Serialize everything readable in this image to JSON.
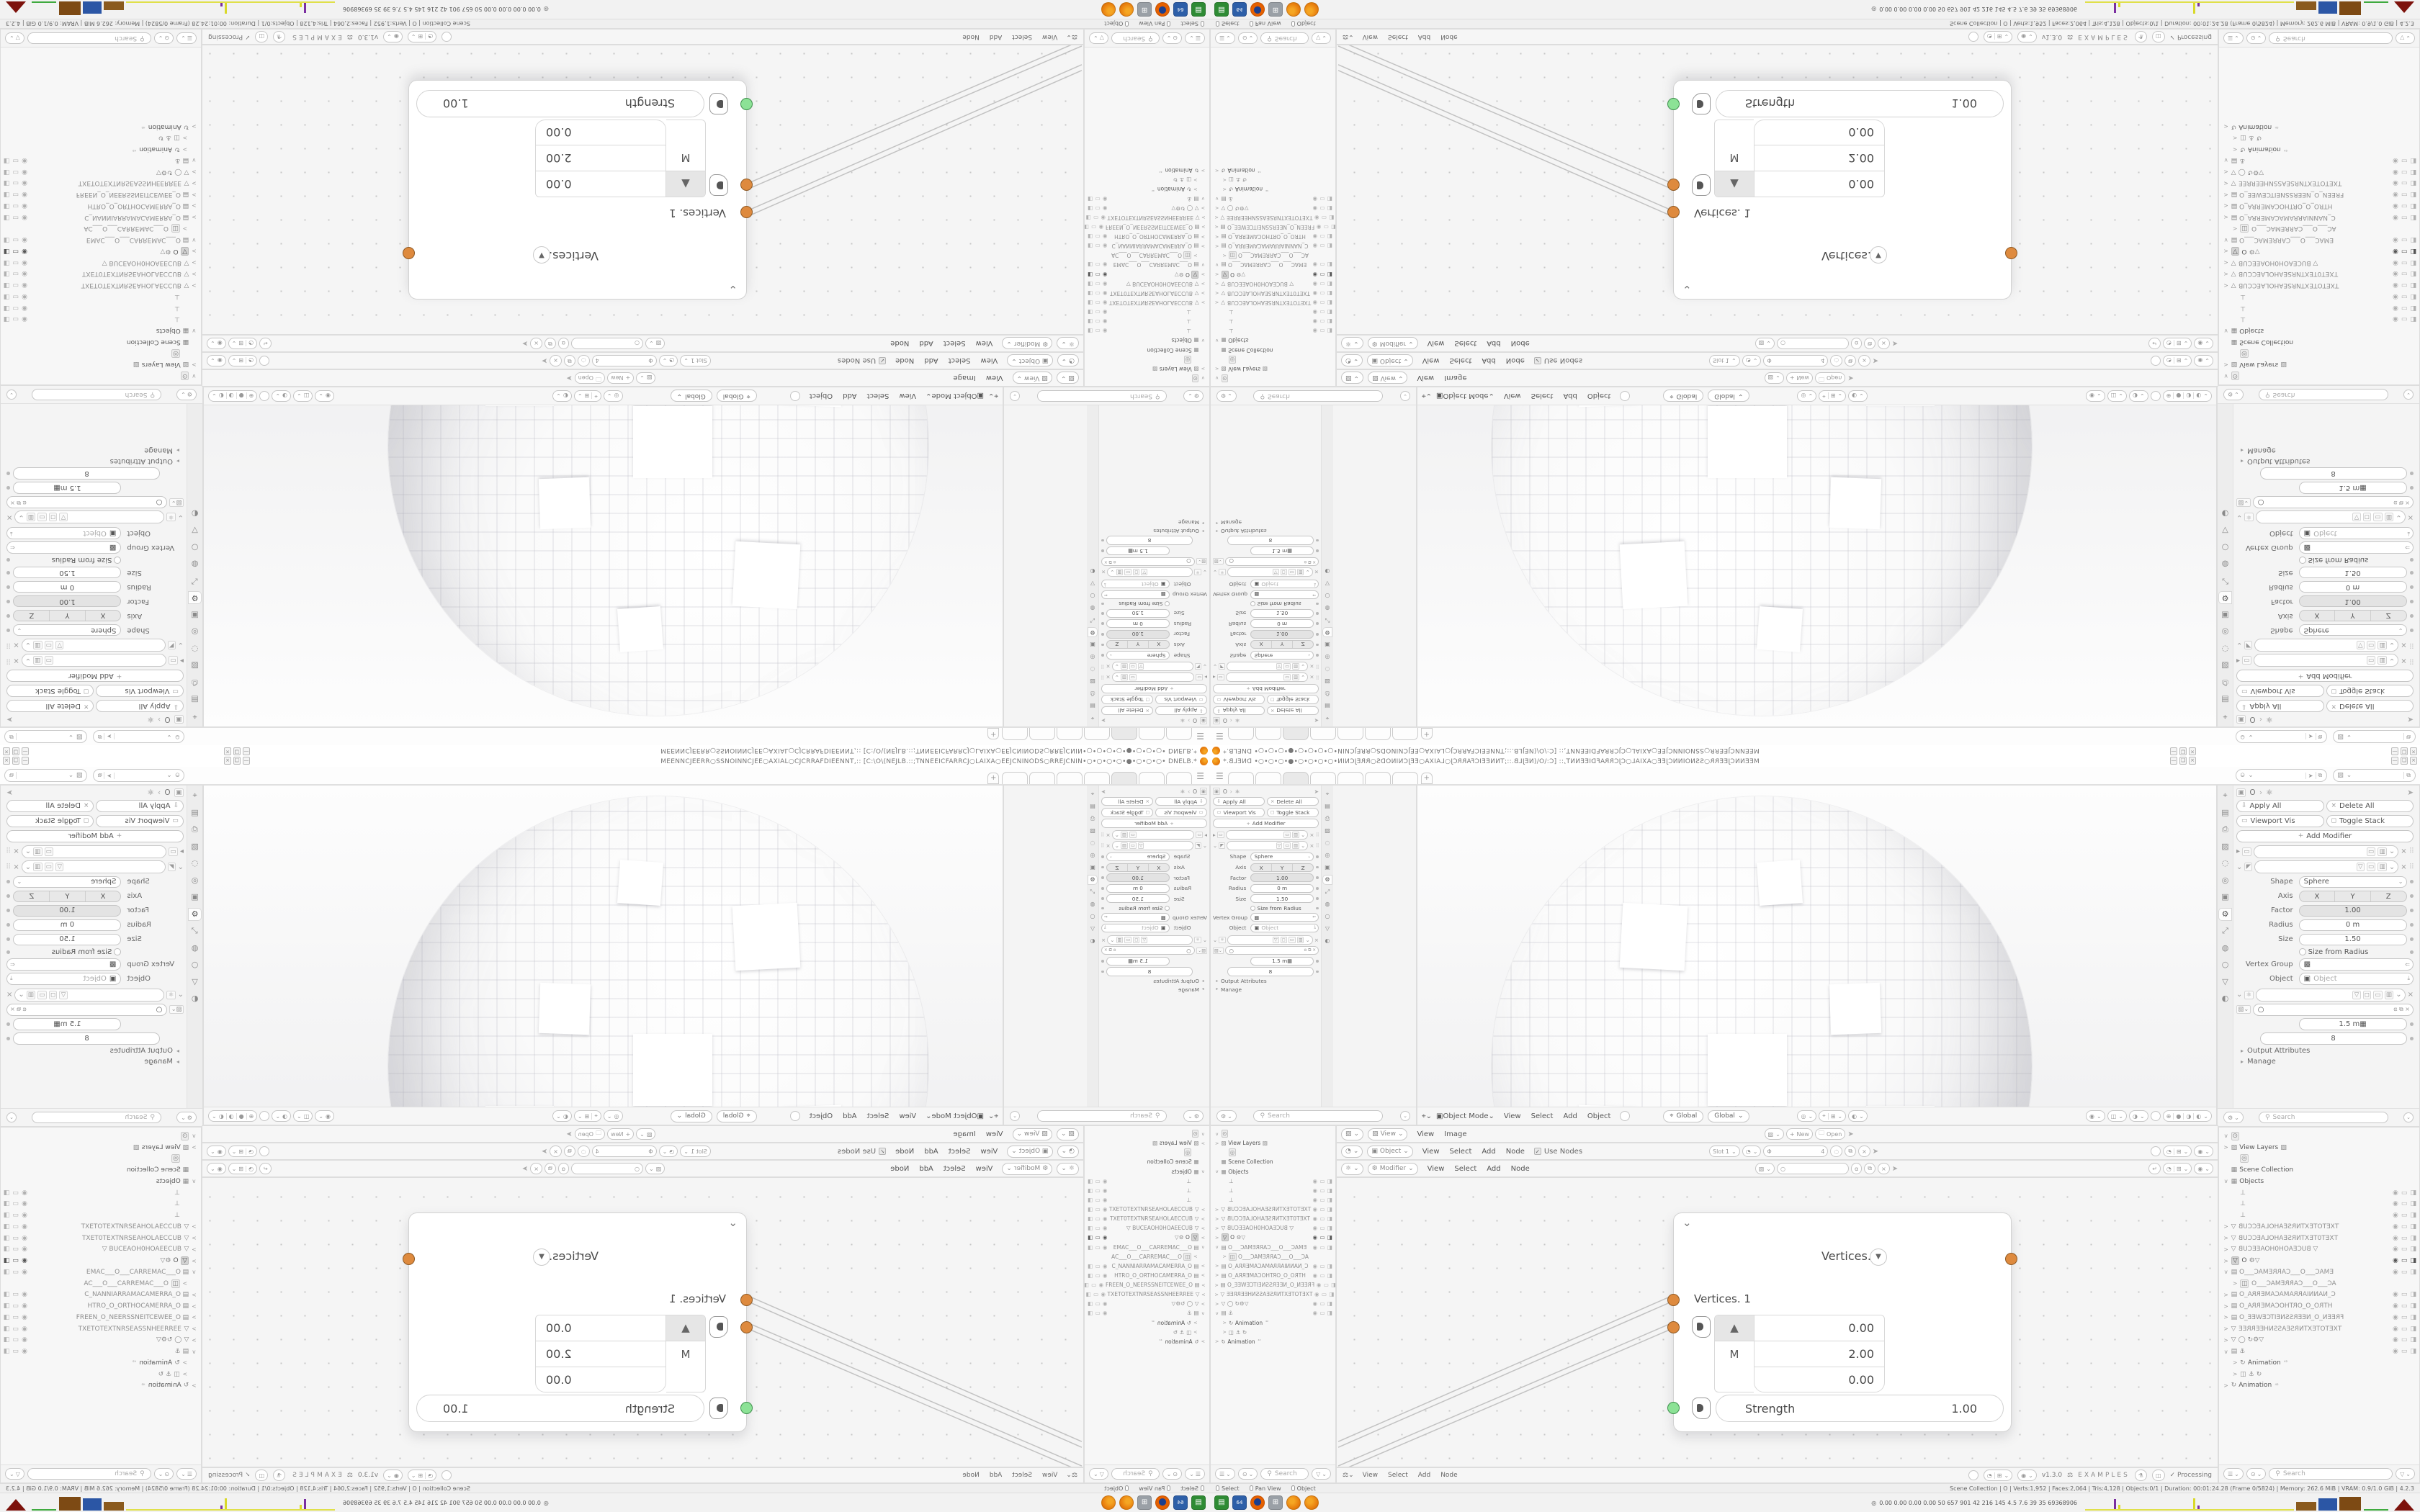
{
  "window": {
    "title_text": "MEENNCJEERR○SSNOINNCJEE○AXIAL○CJCRRAFDIEENNT,:: [C:\\O\\(NEJLB.::;TNNEEICFARRCJ○LAIXA○EEJCNINODS○RREJCNIN•○•○•○•○•●•○•○•○• DNELB.* ",
    "logo_icon": "blender-logo",
    "controls": [
      "—",
      "❏",
      "×"
    ]
  },
  "topbar": {
    "tabs": [
      "",
      "",
      "",
      "",
      "",
      "",
      ""
    ],
    "active_tab": 2,
    "new_tab_label": "+",
    "scene_selector_icon": "scene-icon",
    "viewlayer_selector_icon": "image-icon"
  },
  "props": {
    "breadcrumb_object": "O",
    "apply_all": "Apply All",
    "delete_all": "Delete All",
    "viewport_vis": "Viewport Vis",
    "toggle_stack": "Toggle Stack",
    "add_modifier": "Add Modifier",
    "shape_label": "Shape",
    "shape_value": "Sphere",
    "axis_label": "Axis",
    "axis": [
      "X",
      "Y",
      "Z"
    ],
    "factor_label": "Factor",
    "factor_value": "1.00",
    "radius_label": "Radius",
    "radius_value": "0 m",
    "size_label": "Size",
    "size_value": "1.50",
    "size_from_radius": "Size from Radius",
    "vertex_group_label": "Vertex Group",
    "object_label": "Object",
    "object_placeholder": "Object",
    "gn_length": "1.5 m",
    "gn_count": "8",
    "output_attributes": "Output Attributes",
    "manage": "Manage",
    "search_placeholder": "Search",
    "tab_icons": [
      "⌖",
      "▤",
      "⎙",
      "▨",
      "◌",
      "◎",
      "▣",
      "⚙",
      "⤢",
      "◍",
      "○",
      "▽",
      "◐"
    ],
    "active_tab_index": 7
  },
  "viewport": {
    "mode": "Object Mode",
    "menus": [
      "View",
      "Select",
      "Add",
      "Object"
    ],
    "orientation": "Global"
  },
  "image_header": {
    "editor_menu": "View",
    "menus": [
      "View",
      "Image"
    ],
    "new_label": "New",
    "open_label": "Open"
  },
  "tex_header": {
    "context": "Object",
    "menus": [
      "View",
      "Select",
      "Add",
      "Node"
    ],
    "use_nodes": "Use Nodes",
    "slot": "Slot 1",
    "image_count": "4"
  },
  "gn_header": {
    "context": "Modifier",
    "menus": [
      "View",
      "Select",
      "Add",
      "Node"
    ]
  },
  "node": {
    "title": "Vertices. 1",
    "input_label": "Vertices. 1",
    "vector": [
      "0.00",
      "2.00",
      "0.00"
    ],
    "axis_badge": "M",
    "strength_label": "Strength",
    "strength_value": "1.00"
  },
  "gn_footer": {
    "menus": [
      "View",
      "Select",
      "Add",
      "Node"
    ],
    "version": "v1.3.0",
    "examples": "EXAMPLES",
    "status": "Processing"
  },
  "outliner": {
    "search_placeholder": "Search",
    "rows": [
      {
        "exp": "v",
        "icon": "person",
        "label": "",
        "box": true
      },
      {
        "exp": ">",
        "icon": "image",
        "label": "View Layers",
        "extra": "image"
      },
      {
        "icon": "globe",
        "box": true,
        "ind": 1
      },
      {
        "icon": "coll",
        "label": "Scene Collection"
      },
      {
        "exp": "v",
        "icon": "coll",
        "label": "Objects"
      },
      {
        "icon": "empty",
        "vis": "dim",
        "ind": 1
      },
      {
        "icon": "empty",
        "vis": "dim",
        "ind": 1
      },
      {
        "icon": "empty",
        "vis": "dim",
        "ind": 1
      },
      {
        "exp": ">",
        "icon": "mesh",
        "name": "TXETOTEXTNRSEAHOLAECCUB",
        "flip": true,
        "vis": "dim"
      },
      {
        "exp": ">",
        "icon": "mesh",
        "name": "TXET0TEXTNRSEAHOLAECCUB",
        "flip": true,
        "vis": "dim"
      },
      {
        "exp": ">",
        "icon": "mesh",
        "name": "BUCEAOH0HOAEECUB",
        "flip": true,
        "extra": "mesh",
        "vis": "dim"
      },
      {
        "exp": ">",
        "icon": "mesh",
        "sel": true,
        "label": "O",
        "extra": "tools",
        "vis": "strong"
      },
      {
        "exp": "v",
        "icon": "cam",
        "name": "EMAC___O___CARREMAC___O",
        "flip": true,
        "vis": "dim"
      },
      {
        "exp": ">",
        "icon": "cambox",
        "name": "AC___O___CARREMAC___O",
        "flip": true,
        "ind": 1,
        "box": true
      },
      {
        "exp": ">",
        "icon": "cam",
        "name": "C_NANNIARRAMACAMERRA_O",
        "flip": true,
        "vis": "dim"
      },
      {
        "exp": ">",
        "icon": "cam",
        "name": "HTRO_O_ORTHOCAMERRA_O",
        "flip": true,
        "vis": "dim"
      },
      {
        "exp": ">",
        "icon": "cam",
        "name": "FREEN_O_NEERSSNEITCEWEE_O",
        "flip": true,
        "vis": "dim"
      },
      {
        "exp": ">",
        "icon": "mesh",
        "name": "TXETOTEXTNRSEASSNHEERREE",
        "flip": true,
        "vis": "dim"
      },
      {
        "exp": ">",
        "icon": "mesh",
        "extra": "circle-tools",
        "vis": "dim"
      },
      {
        "exp": "v",
        "icon": "cam",
        "extra": "anchor",
        "vis": "dim"
      },
      {
        "exp": ">",
        "icon": "anim",
        "label": "Animation",
        "ind": 1,
        "badge": "42"
      },
      {
        "exp": ">",
        "icon": "cambox",
        "extra": "anim",
        "ind": 1
      },
      {
        "exp": ">",
        "icon": "anim",
        "label": "Animation",
        "badge": "42"
      }
    ]
  },
  "statusbar": {
    "hints": [
      "Select",
      "Pan View",
      "Object"
    ],
    "stats": "Scene Collection | O | Verts:1,952 | Faces:2,064 | Tris:4,128 | Objects:0/1 | Duration: 00:01:24.28 (Frame 0/5824) | Memory: 262.6 MiB | VRAM: 0.9/1.0 GiB | 4.2.3"
  },
  "taskbar": {
    "apps": [
      "save",
      "save64",
      "firefox",
      "calc",
      "blender",
      "blender"
    ],
    "monitor_values": "0.00 0.00 0.00 0.00   50   657   901   42   216   145   4.5   7.6   39   35   69368906"
  }
}
